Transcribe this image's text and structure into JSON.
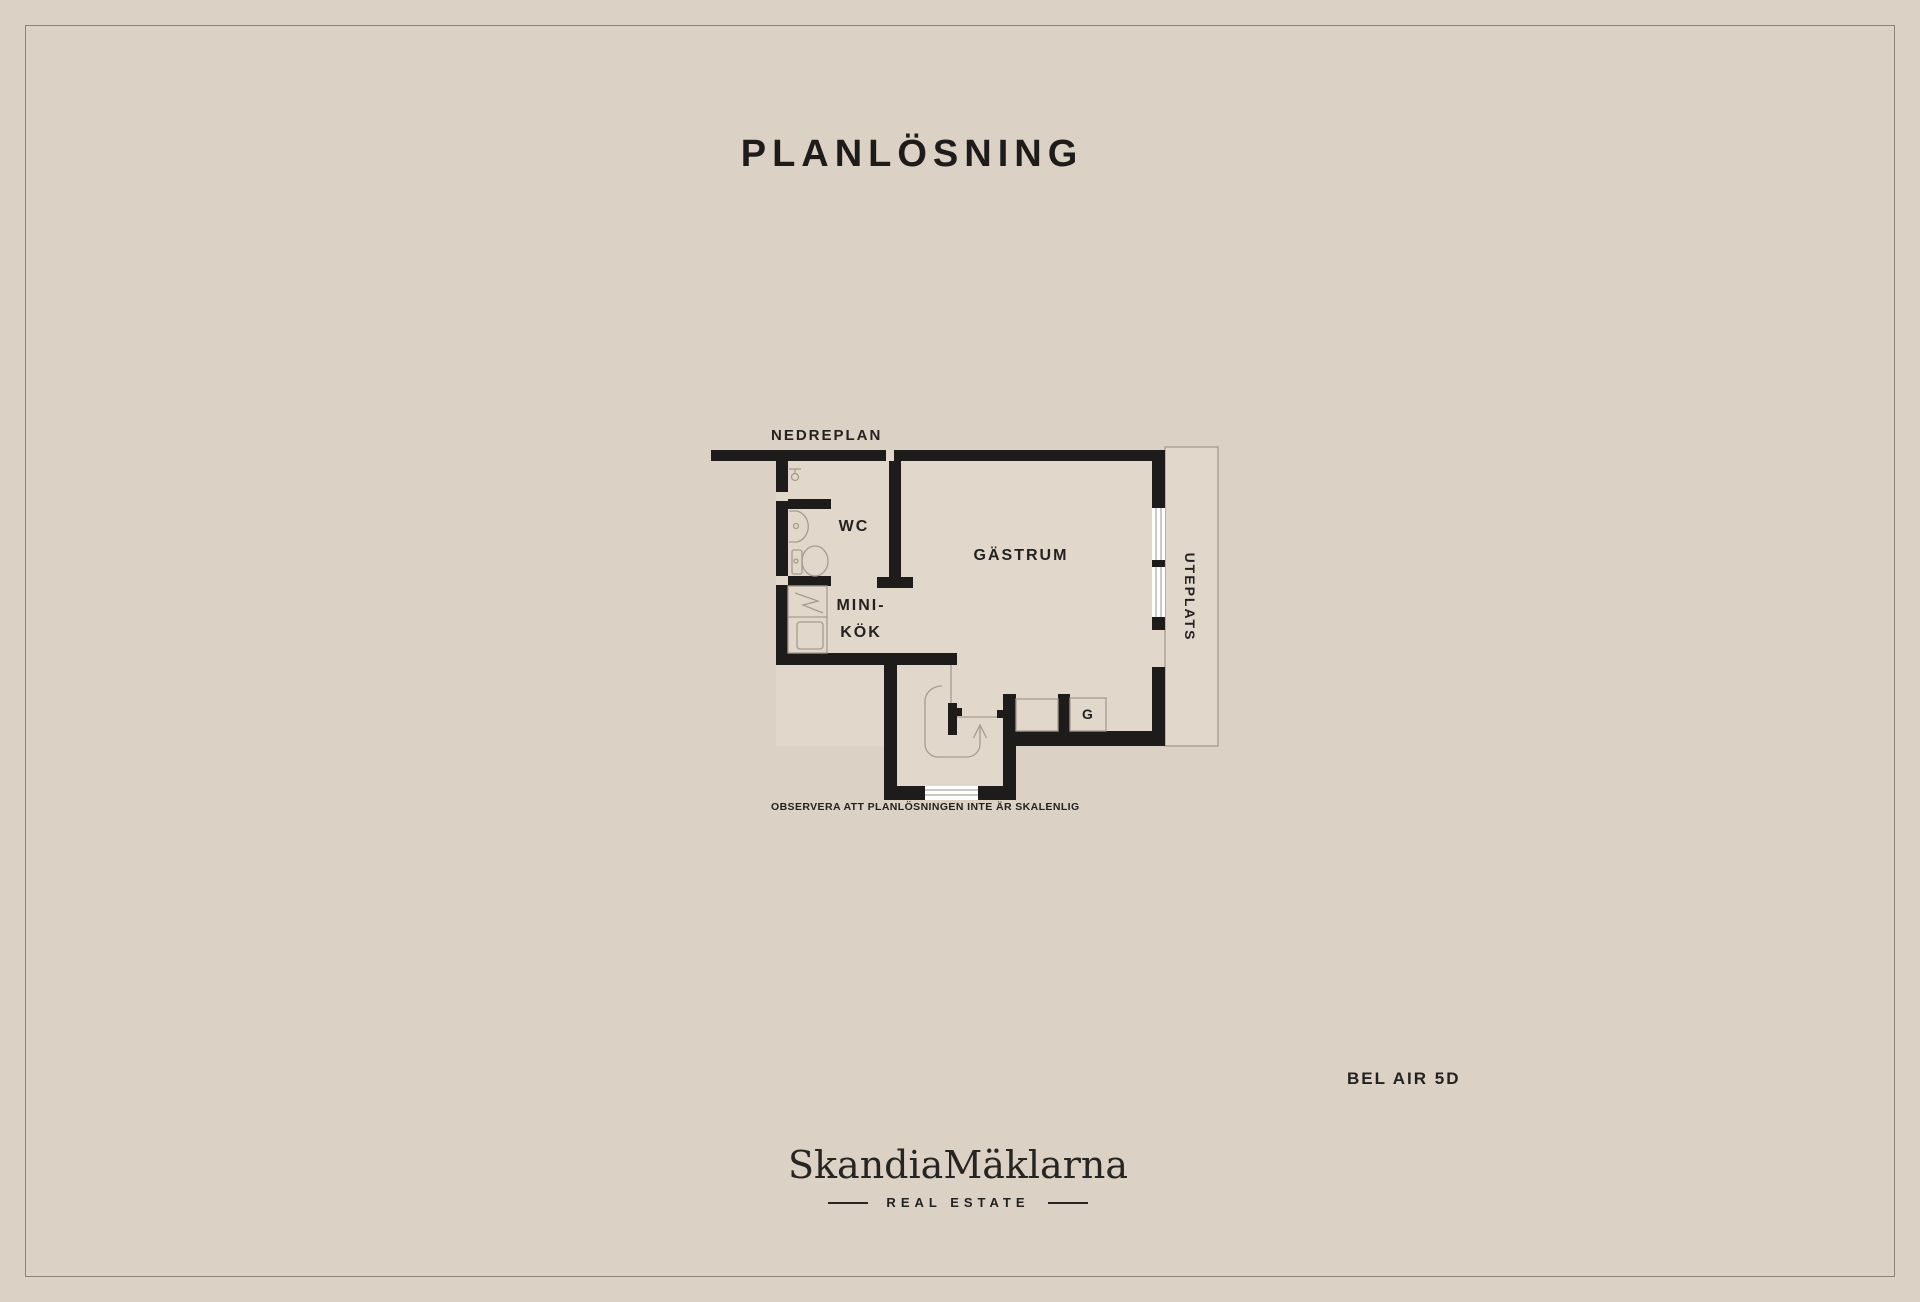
{
  "page": {
    "title": "PLANLÖSNING",
    "property_name": "BEL AIR 5D"
  },
  "plan": {
    "floor_label": "NEDREPLAN",
    "disclaimer": "OBSERVERA ATT PLANLÖSNINGEN INTE ÄR SKALENLIG"
  },
  "rooms": {
    "wc": "WC",
    "minikitchen_line1": "MINI-",
    "minikitchen_line2": "KÖK",
    "guest_room": "GÄSTRUM",
    "wardrobe": "G",
    "terrace": "UTEPLATS"
  },
  "brand": {
    "logo": "SkandiaMäklarna",
    "tagline": "REAL ESTATE"
  },
  "colors": {
    "background": "#dcd1c5",
    "floor": "#e2d7cb",
    "wall": "#1d1c1a",
    "text": "#232220",
    "thin_line": "#a59c8e",
    "frame_line": "#8d8277"
  }
}
